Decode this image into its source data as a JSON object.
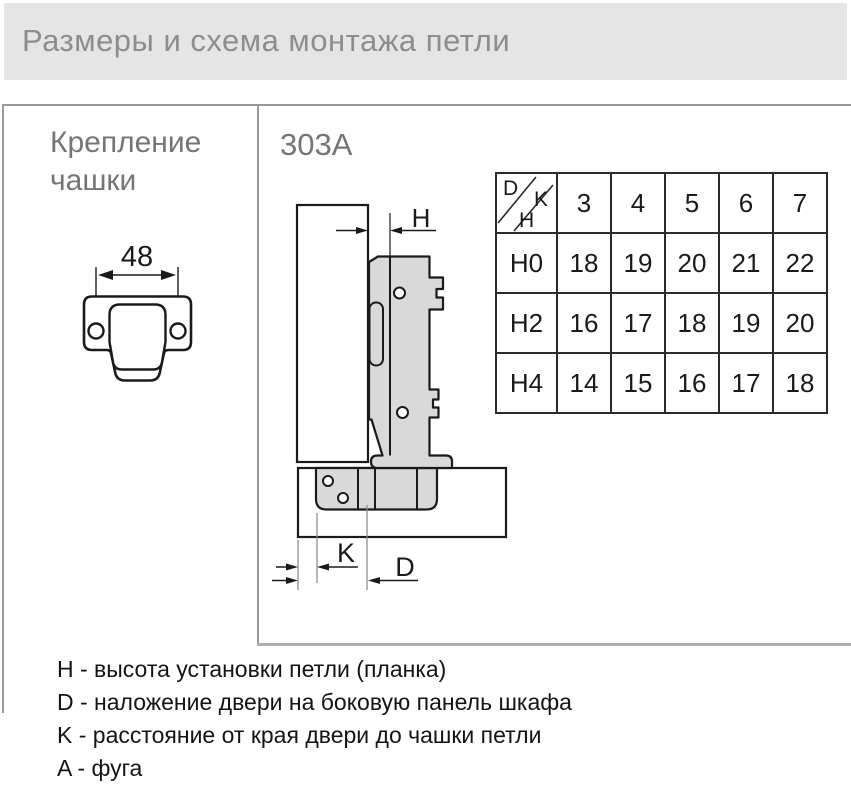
{
  "header": {
    "title": "Размеры и схема монтажа петли"
  },
  "left_panel": {
    "title_line1": "Крепление",
    "title_line2": "чашки",
    "cup_width_label": "48"
  },
  "right_panel": {
    "model": "303A",
    "dim_h_label": "H",
    "dim_k_label": "K",
    "dim_d_label": "D"
  },
  "table": {
    "corner": {
      "d": "D",
      "k": "K",
      "h": "H"
    },
    "columns": [
      "3",
      "4",
      "5",
      "6",
      "7"
    ],
    "rows": [
      {
        "label": "H0",
        "values": [
          "18",
          "19",
          "20",
          "21",
          "22"
        ]
      },
      {
        "label": "H2",
        "values": [
          "16",
          "17",
          "18",
          "19",
          "20"
        ]
      },
      {
        "label": "H4",
        "values": [
          "14",
          "15",
          "16",
          "17",
          "18"
        ]
      }
    ]
  },
  "chart_data": {
    "type": "table",
    "corner_axes": {
      "column_axis": "K",
      "row_axis": "H",
      "value": "D"
    },
    "columns_K": [
      3,
      4,
      5,
      6,
      7
    ],
    "rows_H": [
      "H0",
      "H2",
      "H4"
    ],
    "values_D": [
      [
        18,
        19,
        20,
        21,
        22
      ],
      [
        16,
        17,
        18,
        19,
        20
      ],
      [
        14,
        15,
        16,
        17,
        18
      ]
    ]
  },
  "legend": {
    "items": [
      "H - высота установки петли (планка)",
      "D - наложение двери на боковую панель шкафа",
      "K - расстояние от края двери до чашки петли",
      "A - фуга"
    ]
  },
  "colors": {
    "header_bg": "#e5e5e5",
    "header_text": "#8d8d8d",
    "panel_title_text": "#757575",
    "drawing_outline": "#1a1a1a",
    "drawing_fill": "#d9d9d9",
    "table_border": "#2b2b2b",
    "box_border": "#9a9a9a"
  }
}
